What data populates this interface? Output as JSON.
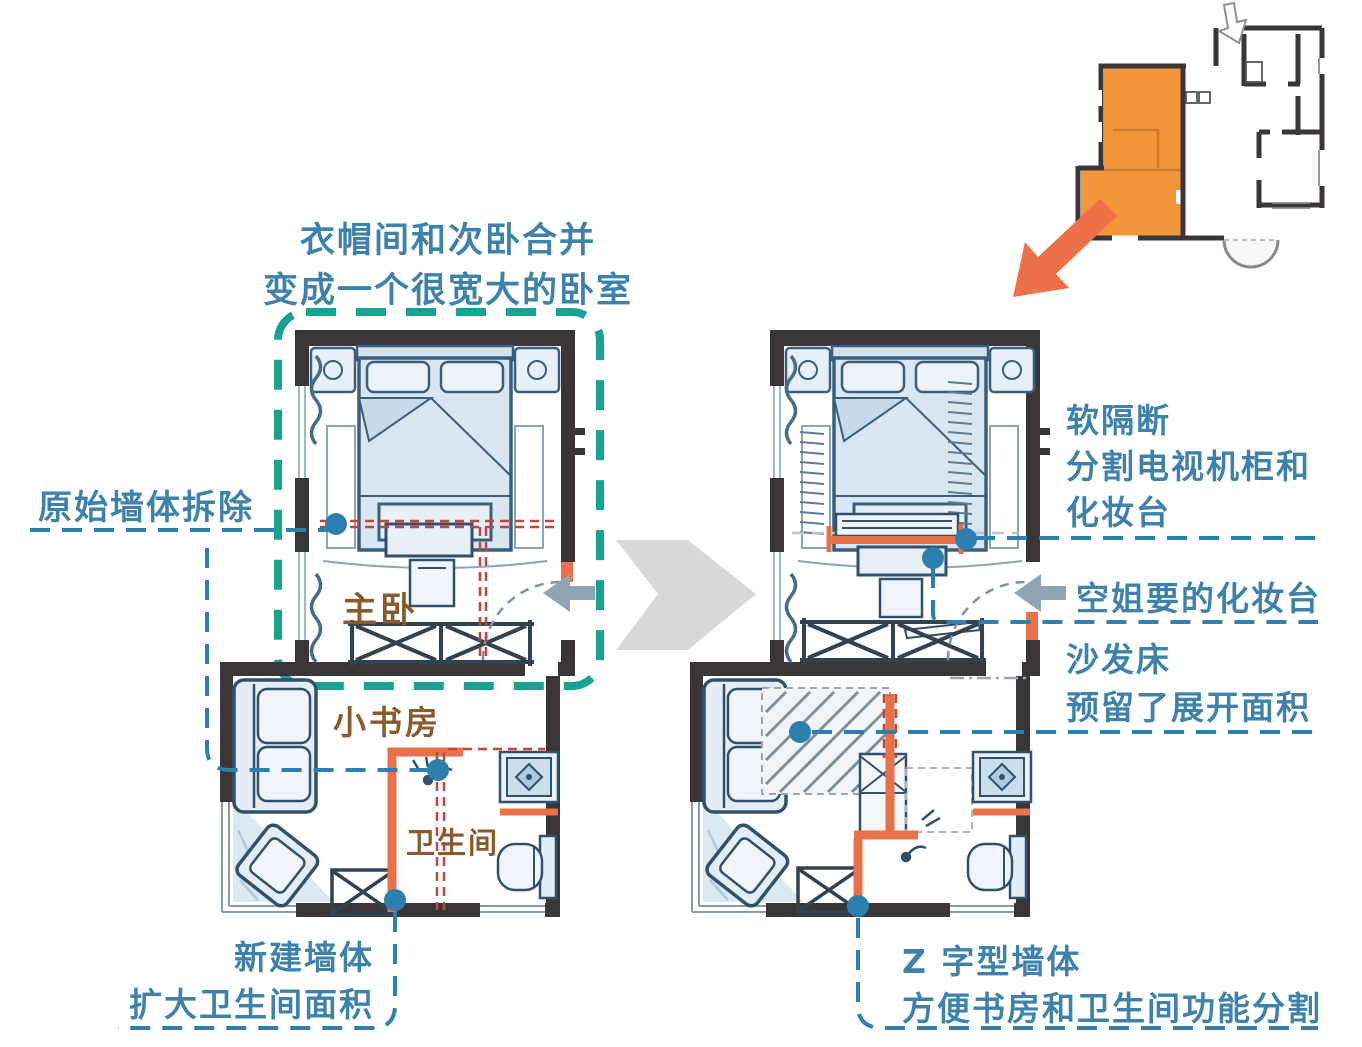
{
  "colors": {
    "label_blue": "#3E81AB",
    "teal": "#16A390",
    "brown": "#8A5A2E",
    "red_dash": "#C4453C",
    "orange_wall": "#E8714A",
    "orange_fill": "#F2953B",
    "arrow_gray": "#D8D8D8",
    "arrow_slate": "#8FA5B5",
    "dot_blue": "#2C7FAE",
    "wall_dark": "#3A3537"
  },
  "annotations": {
    "merge_note": {
      "line1": "衣帽间和次卧合并",
      "line2": "变成一个很宽大的卧室"
    },
    "original_wall": {
      "text": "原始墙体拆除"
    },
    "new_wall": {
      "line1": "新建墙体",
      "line2": "扩大卫生间面积"
    },
    "soft_partition": {
      "line1": "软隔断",
      "line2": "分割电视机柜和",
      "line3": "化妆台"
    },
    "dressing_table": {
      "text": "空姐要的化妆台"
    },
    "sofa_bed": {
      "line1": "沙发床",
      "line2": "预留了展开面积"
    },
    "z_wall": {
      "line1": "Z 字型墙体",
      "line2": "方便书房和卫生间功能分割"
    }
  },
  "rooms": {
    "master_bedroom": "主卧",
    "study": "小书房",
    "bathroom": "卫生间"
  }
}
